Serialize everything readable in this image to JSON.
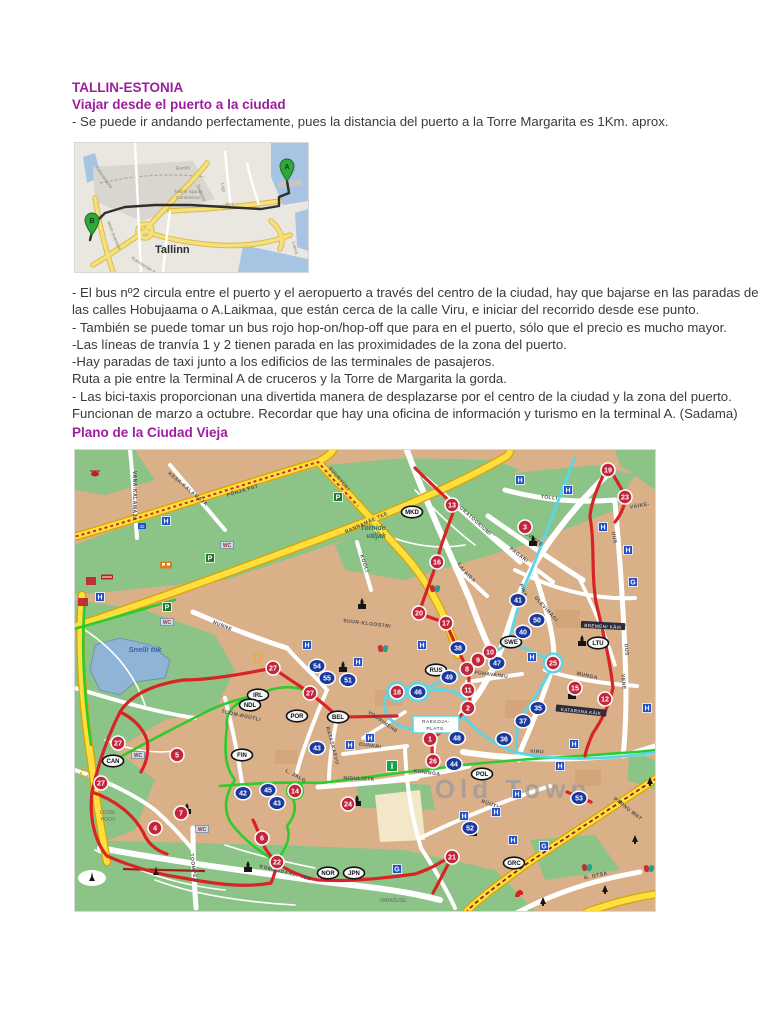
{
  "doc": {
    "title": "TALLIN-ESTONIA",
    "subtitle": "Viajar desde el puerto a la ciudad",
    "intro": "- Se puede ir andando perfectamente, pues la distancia del puerto a la Torre Margarita es 1Km. aprox.",
    "body_lines": [
      "- El bus nº2 circula entre el puerto y el aeropuerto a través del centro de la ciudad, hay que bajarse en las paradas de",
      "las calles Hobujaama o A.Laikmaa, que están cerca de la calle Viru, e iniciar del recorrido desde ese punto.",
      "- También se puede tomar un bus rojo hop-on/hop-off que para en el puerto, sólo que el precio es mucho mayor.",
      "-Las líneas de tranvía 1 y 2 tienen parada en las proximidades de la zona del puerto.",
      "-Hay paradas de taxi junto a los edificios de las terminales de pasajeros.",
      "Ruta a pie entre la Terminal A de cruceros y la Torre de Margarita la gorda.",
      "- Las bici-taxis proporcionan una divertida manera de desplazarse por el centro de la ciudad y la zona del puerto.",
      "Funcionan de marzo a octubre. Recordar que hay una oficina de información y turismo en la terminal A. (Sadama)"
    ],
    "section2_heading": "Plano de la Ciudad Vieja",
    "heading_color": "#9c1e9c"
  },
  "route_map": {
    "city_label": "Tallinn",
    "markers": [
      {
        "letter": "A",
        "x": 212,
        "y": 35
      },
      {
        "letter": "B",
        "x": 17,
        "y": 89
      }
    ],
    "street_labels": [
      {
        "t": "Kalasadama",
        "x": 20,
        "y": 24,
        "r": 55
      },
      {
        "t": "Rumbi",
        "x": 101,
        "y": 27,
        "r": -4
      },
      {
        "t": "Tallink Spa &",
        "x": 99,
        "y": 50,
        "r": 0
      },
      {
        "t": "Conference",
        "x": 101,
        "y": 56,
        "r": 0
      },
      {
        "t": "Sadama",
        "x": 121,
        "y": 42,
        "r": 66
      },
      {
        "t": "Logi",
        "x": 146,
        "y": 40,
        "r": 80
      },
      {
        "t": "Kai",
        "x": 151,
        "y": 63,
        "r": -6
      },
      {
        "t": "Mere puiestee",
        "x": 32,
        "y": 79,
        "r": 68
      },
      {
        "t": "Rannamäe tee",
        "x": 56,
        "y": 116,
        "r": 32
      },
      {
        "t": "Laeva",
        "x": 217,
        "y": 99,
        "r": 75
      }
    ],
    "colors": {
      "water": "#a7c5e3",
      "land": "#eae7e1",
      "railyard": "#d9d6cf",
      "road_yellow": "#f6e07a",
      "route": "#2f2f2f",
      "pin_green": "#2fa838"
    }
  },
  "old_town_map": {
    "colors": {
      "building": "#d9b088",
      "park": "#8cc487",
      "water": "#8fb4d6",
      "road_yellow": "#ffdf3f",
      "road_casing": "#d9a400",
      "route_red": "#d82327",
      "route_green": "#2bcc2b",
      "route_cyan": "#59d7e8",
      "stop_red": "#c3263c",
      "stop_blue": "#1c3a9e",
      "hotel_blue": "#2050c8",
      "parking_green": "#1e7e2e",
      "info_green": "#17a14b"
    },
    "stops_red": [
      {
        "n": "1",
        "x": 355,
        "y": 289
      },
      {
        "n": "2",
        "x": 393,
        "y": 258
      },
      {
        "n": "3",
        "x": 450,
        "y": 77
      },
      {
        "n": "4",
        "x": 80,
        "y": 378
      },
      {
        "n": "5",
        "x": 102,
        "y": 305
      },
      {
        "n": "6",
        "x": 187,
        "y": 388
      },
      {
        "n": "7",
        "x": 106,
        "y": 363
      },
      {
        "n": "8",
        "x": 392,
        "y": 219
      },
      {
        "n": "9",
        "x": 403,
        "y": 210
      },
      {
        "n": "10",
        "x": 415,
        "y": 202
      },
      {
        "n": "11",
        "x": 393,
        "y": 240
      },
      {
        "n": "12",
        "x": 530,
        "y": 249
      },
      {
        "n": "13",
        "x": 377,
        "y": 55
      },
      {
        "n": "14",
        "x": 220,
        "y": 341
      },
      {
        "n": "15",
        "x": 500,
        "y": 238
      },
      {
        "n": "16",
        "x": 362,
        "y": 112
      },
      {
        "n": "17",
        "x": 371,
        "y": 173
      },
      {
        "n": "18",
        "x": 322,
        "y": 242,
        "ring": true
      },
      {
        "n": "19",
        "x": 533,
        "y": 20
      },
      {
        "n": "20",
        "x": 344,
        "y": 163
      },
      {
        "n": "21",
        "x": 377,
        "y": 407
      },
      {
        "n": "22",
        "x": 202,
        "y": 412
      },
      {
        "n": "23",
        "x": 550,
        "y": 47
      },
      {
        "n": "24",
        "x": 273,
        "y": 354
      },
      {
        "n": "25",
        "x": 478,
        "y": 213,
        "ring": true
      },
      {
        "n": "26",
        "x": 358,
        "y": 311
      },
      {
        "n": "27",
        "x": 198,
        "y": 218
      },
      {
        "n": "27",
        "x": 235,
        "y": 243
      },
      {
        "n": "27",
        "x": 43,
        "y": 293
      },
      {
        "n": "27",
        "x": 26,
        "y": 333
      }
    ],
    "stops_blue": [
      {
        "n": "35",
        "x": 463,
        "y": 258
      },
      {
        "n": "36",
        "x": 429,
        "y": 289
      },
      {
        "n": "37",
        "x": 448,
        "y": 271
      },
      {
        "n": "38",
        "x": 383,
        "y": 198
      },
      {
        "n": "40",
        "x": 448,
        "y": 182
      },
      {
        "n": "41",
        "x": 443,
        "y": 150
      },
      {
        "n": "42",
        "x": 168,
        "y": 343
      },
      {
        "n": "43",
        "x": 242,
        "y": 298
      },
      {
        "n": "43",
        "x": 202,
        "y": 353
      },
      {
        "n": "44",
        "x": 379,
        "y": 314
      },
      {
        "n": "45",
        "x": 193,
        "y": 340
      },
      {
        "n": "46",
        "x": 343,
        "y": 242,
        "ring": true
      },
      {
        "n": "47",
        "x": 422,
        "y": 213
      },
      {
        "n": "48",
        "x": 382,
        "y": 288
      },
      {
        "n": "49",
        "x": 374,
        "y": 227
      },
      {
        "n": "50",
        "x": 462,
        "y": 170
      },
      {
        "n": "51",
        "x": 273,
        "y": 230
      },
      {
        "n": "52",
        "x": 395,
        "y": 378
      },
      {
        "n": "53",
        "x": 504,
        "y": 348
      },
      {
        "n": "54",
        "x": 242,
        "y": 216
      },
      {
        "n": "55",
        "x": 252,
        "y": 228
      }
    ],
    "embassies": [
      {
        "code": "MKD",
        "x": 337,
        "y": 62
      },
      {
        "code": "IRL",
        "x": 183,
        "y": 245
      },
      {
        "code": "NDL",
        "x": 175,
        "y": 255
      },
      {
        "code": "POR",
        "x": 222,
        "y": 266
      },
      {
        "code": "BEL",
        "x": 263,
        "y": 267
      },
      {
        "code": "RUS",
        "x": 361,
        "y": 220
      },
      {
        "code": "SWE",
        "x": 436,
        "y": 192
      },
      {
        "code": "LTU",
        "x": 523,
        "y": 193
      },
      {
        "code": "CAN",
        "x": 38,
        "y": 311
      },
      {
        "code": "FIN",
        "x": 167,
        "y": 305
      },
      {
        "code": "POL",
        "x": 407,
        "y": 324
      },
      {
        "code": "NOR",
        "x": 253,
        "y": 423
      },
      {
        "code": "JPN",
        "x": 279,
        "y": 423
      },
      {
        "code": "GRC",
        "x": 439,
        "y": 413
      }
    ],
    "badges": [
      {
        "k": "H",
        "x": 91,
        "y": 71
      },
      {
        "k": "H",
        "x": 25,
        "y": 147
      },
      {
        "k": "H",
        "x": 445,
        "y": 30
      },
      {
        "k": "H",
        "x": 493,
        "y": 40
      },
      {
        "k": "H",
        "x": 528,
        "y": 77
      },
      {
        "k": "H",
        "x": 553,
        "y": 100
      },
      {
        "k": "H",
        "x": 232,
        "y": 195
      },
      {
        "k": "H",
        "x": 347,
        "y": 195
      },
      {
        "k": "H",
        "x": 283,
        "y": 212
      },
      {
        "k": "H",
        "x": 457,
        "y": 207
      },
      {
        "k": "H",
        "x": 499,
        "y": 294
      },
      {
        "k": "H",
        "x": 485,
        "y": 316
      },
      {
        "k": "H",
        "x": 442,
        "y": 344
      },
      {
        "k": "H",
        "x": 421,
        "y": 362
      },
      {
        "k": "H",
        "x": 389,
        "y": 366
      },
      {
        "k": "H",
        "x": 438,
        "y": 390
      },
      {
        "k": "H",
        "x": 295,
        "y": 288
      },
      {
        "k": "H",
        "x": 275,
        "y": 295
      },
      {
        "k": "H",
        "x": 572,
        "y": 258
      },
      {
        "k": "P",
        "x": 263,
        "y": 47
      },
      {
        "k": "P",
        "x": 135,
        "y": 108
      },
      {
        "k": "P",
        "x": 92,
        "y": 157
      },
      {
        "k": "WC",
        "x": 152,
        "y": 95
      },
      {
        "k": "WC",
        "x": 92,
        "y": 172
      },
      {
        "k": "WC",
        "x": 63,
        "y": 305
      },
      {
        "k": "WC",
        "x": 127,
        "y": 379
      },
      {
        "k": "G",
        "x": 558,
        "y": 132
      },
      {
        "k": "G",
        "x": 469,
        "y": 396
      },
      {
        "k": "G",
        "x": 322,
        "y": 419
      },
      {
        "k": "i",
        "x": 317,
        "y": 316
      },
      {
        "k": "32",
        "x": 67,
        "y": 76
      }
    ],
    "street_labels": [
      {
        "t": "PÕHJA PST",
        "x": 168,
        "y": 42,
        "r": -17
      },
      {
        "t": "SUURTÜKI",
        "x": 263,
        "y": 30,
        "r": 50
      },
      {
        "t": "RANNAMÄE TEE",
        "x": 292,
        "y": 74,
        "r": -24
      },
      {
        "t": "VANA-KALAMAJA",
        "x": 58,
        "y": 46,
        "r": 90
      },
      {
        "t": "KESK-KALAMAJA",
        "x": 112,
        "y": 40,
        "r": 40
      },
      {
        "t": "LABORATOORIUMI",
        "x": 395,
        "y": 68,
        "r": 42
      },
      {
        "t": "TOLLI",
        "x": 474,
        "y": 49,
        "r": 6
      },
      {
        "t": "OLEVISTE",
        "x": 455,
        "y": 88,
        "r": 36
      },
      {
        "t": "PAGARI",
        "x": 443,
        "y": 106,
        "r": 38
      },
      {
        "t": "PIKK",
        "x": 447,
        "y": 141,
        "r": 68
      },
      {
        "t": "LAI",
        "x": 385,
        "y": 118,
        "r": 62
      },
      {
        "t": "OLEVIMÄGI",
        "x": 470,
        "y": 160,
        "r": 48
      },
      {
        "t": "VENE",
        "x": 547,
        "y": 232,
        "r": 85
      },
      {
        "t": "UUS",
        "x": 538,
        "y": 88,
        "r": 80
      },
      {
        "t": "UUS",
        "x": 550,
        "y": 200,
        "r": 85
      },
      {
        "t": "MUNGA",
        "x": 512,
        "y": 227,
        "r": 12
      },
      {
        "t": "BREMENI KÄIK",
        "x": 528,
        "y": 177,
        "r": 3,
        "band": true
      },
      {
        "t": "KATARIINA KÄIK",
        "x": 506,
        "y": 262,
        "r": 6,
        "band": true
      },
      {
        "t": "SUUR-KLOOSTRI",
        "x": 292,
        "y": 175,
        "r": 7
      },
      {
        "t": "NUNNE",
        "x": 147,
        "y": 177,
        "r": 22
      },
      {
        "t": "TOOM-RÜÜTLI",
        "x": 166,
        "y": 267,
        "r": 12
      },
      {
        "t": "RATASKAEVU",
        "x": 256,
        "y": 296,
        "r": 75
      },
      {
        "t": "DUNKRI",
        "x": 295,
        "y": 297,
        "r": 8
      },
      {
        "t": "VOORIMEHE",
        "x": 307,
        "y": 273,
        "r": 35
      },
      {
        "t": "L. JALG",
        "x": 220,
        "y": 327,
        "r": 28
      },
      {
        "t": "NIGULISTE",
        "x": 284,
        "y": 330,
        "r": 2
      },
      {
        "t": "KUNINGA",
        "x": 352,
        "y": 324,
        "r": 7
      },
      {
        "t": "RÜÜTLI",
        "x": 416,
        "y": 356,
        "r": 20
      },
      {
        "t": "VIRU",
        "x": 462,
        "y": 303,
        "r": 2
      },
      {
        "t": "PÜHAVAIMU",
        "x": 416,
        "y": 226,
        "r": 7
      },
      {
        "t": "TOOMPEA",
        "x": 117,
        "y": 418,
        "r": 82
      },
      {
        "t": "KOMANDANDI TEE",
        "x": 210,
        "y": 424,
        "r": 14
      },
      {
        "t": "G. OTSA",
        "x": 521,
        "y": 427,
        "r": -12
      },
      {
        "t": "PÄRNU MNT",
        "x": 552,
        "y": 360,
        "r": 38
      },
      {
        "t": "KOOLI",
        "x": 288,
        "y": 114,
        "r": 72
      },
      {
        "t": "AIDA",
        "x": 394,
        "y": 128,
        "r": 42
      },
      {
        "t": "VÄIKE-",
        "x": 565,
        "y": 57,
        "r": -10
      }
    ],
    "area_labels": [
      {
        "t": "Tornide",
        "x": 298,
        "y": 80,
        "fs": 7,
        "c": "#2f6f66",
        "i": true,
        "b": true
      },
      {
        "t": "väljak",
        "x": 301,
        "y": 88,
        "fs": 7,
        "c": "#2f6f66",
        "i": true,
        "b": true
      },
      {
        "t": "Snelli tiik",
        "x": 70,
        "y": 202,
        "fs": 7.5,
        "c": "#3a5fb0",
        "i": true,
        "b": true
      },
      {
        "t": "LOSSI-",
        "x": 33,
        "y": 364,
        "fs": 5,
        "c": "#6b6b6b"
      },
      {
        "t": "HOOV",
        "x": 33,
        "y": 371,
        "fs": 5,
        "c": "#6b6b6b"
      },
      {
        "t": "VABADUSE",
        "x": 318,
        "y": 452,
        "fs": 5,
        "c": "#6b6b6b"
      },
      {
        "t": "Old Town",
        "x": 438,
        "y": 348,
        "fs": 26,
        "c": "#98999e",
        "b": true,
        "ls": 5,
        "op": 0.72
      }
    ],
    "plats_box": {
      "line1": "RAEKOJA-",
      "line2": "PLATS.",
      "x": 361,
      "y": 276
    },
    "icons": [
      {
        "k": "church",
        "x": 287,
        "y": 155
      },
      {
        "k": "church",
        "x": 458,
        "y": 92
      },
      {
        "k": "church",
        "x": 268,
        "y": 218
      },
      {
        "k": "church",
        "x": 507,
        "y": 192
      },
      {
        "k": "church",
        "x": 497,
        "y": 245
      },
      {
        "k": "church",
        "x": 282,
        "y": 352
      },
      {
        "k": "church",
        "x": 112,
        "y": 360
      },
      {
        "k": "church",
        "x": 398,
        "y": 382
      },
      {
        "k": "church",
        "x": 173,
        "y": 418
      },
      {
        "k": "monument",
        "x": 81,
        "y": 422
      },
      {
        "k": "monument",
        "x": 17,
        "y": 428
      },
      {
        "k": "tree",
        "x": 560,
        "y": 390
      },
      {
        "k": "tree",
        "x": 530,
        "y": 440
      },
      {
        "k": "tree",
        "x": 468,
        "y": 452
      },
      {
        "k": "tree",
        "x": 575,
        "y": 332
      },
      {
        "k": "bus",
        "x": 91,
        "y": 115
      },
      {
        "k": "train",
        "x": 32,
        "y": 127
      },
      {
        "k": "heli",
        "x": 20,
        "y": 24
      },
      {
        "k": "masks",
        "x": 360,
        "y": 138
      },
      {
        "k": "masks",
        "x": 308,
        "y": 198
      },
      {
        "k": "masks",
        "x": 512,
        "y": 417
      },
      {
        "k": "masks",
        "x": 574,
        "y": 418
      },
      {
        "k": "lion",
        "x": 444,
        "y": 444
      },
      {
        "k": "burst",
        "x": 10,
        "y": 323
      },
      {
        "k": "burst",
        "x": 183,
        "y": 208
      },
      {
        "k": "redbldg",
        "x": 8,
        "y": 152
      },
      {
        "k": "redbldg",
        "x": 16,
        "y": 131
      }
    ]
  }
}
